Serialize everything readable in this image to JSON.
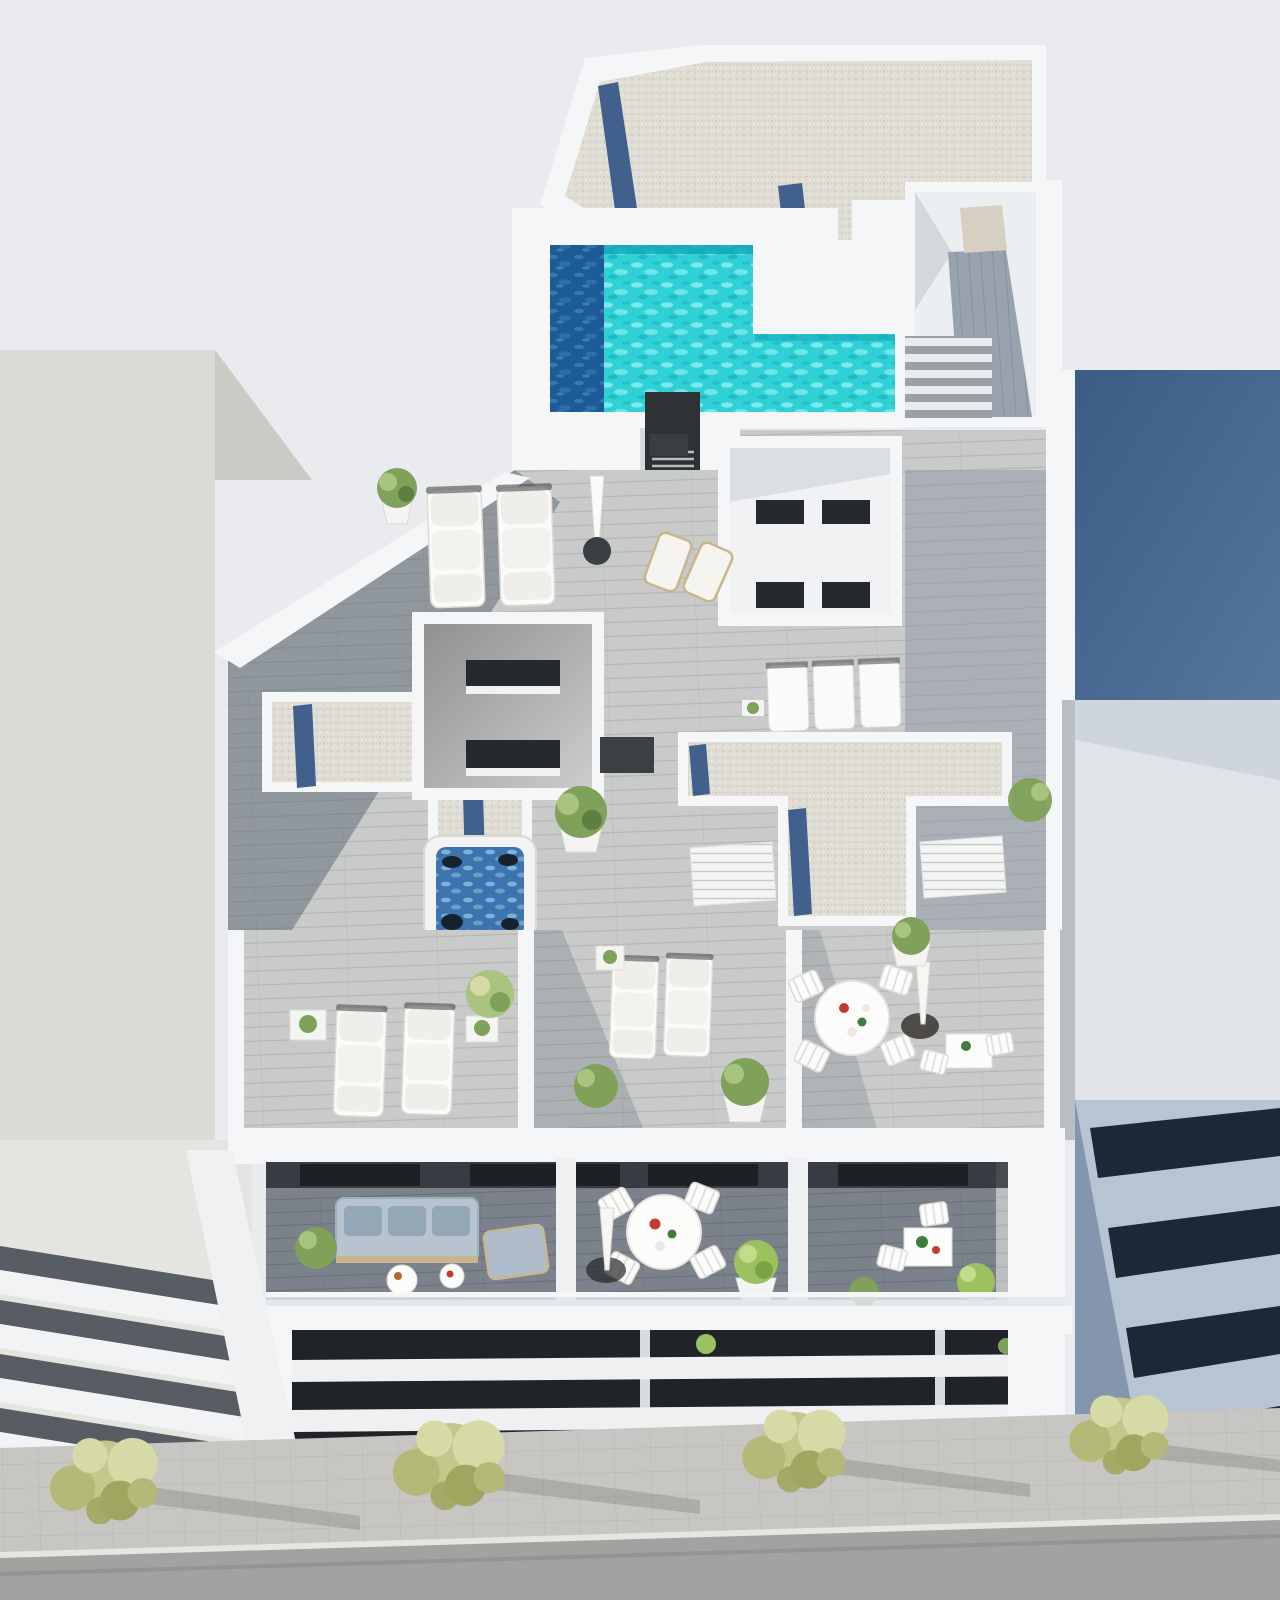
{
  "scene": {
    "description": "aerial-3d-render-of-white-apartment-building-rooftop-terraces",
    "rooftop": {
      "pool": {
        "shape": "L",
        "water": "turquoise",
        "deep_band": "navy-left-edge"
      },
      "gravel_roof_sections": 3,
      "solar_panel_strips": 6,
      "stair_headhouse": 1,
      "vent_chimney": 1
    },
    "terraces": {
      "sun_loungers": 9,
      "deck_chairs": 2,
      "parasols": 3,
      "jacuzzi": 1,
      "round_dining_tables": 2,
      "small_tables": 5,
      "chairs": 12,
      "sofa_sets": 1,
      "plant_pots": 14,
      "lightwell_courtyards": 2
    },
    "street": {
      "trees": 4,
      "sidewalk": "paved",
      "road": "asphalt"
    },
    "neighbors": {
      "left": "plain-light-grey-building",
      "right": "blue-grey-building-with-dark-window-bands"
    }
  },
  "colors": {
    "sky": "#e9ebee",
    "white1": "#f5f6f7",
    "white2": "#e8eaec",
    "whiteShade": "#d7dbdf",
    "nbLeft": "#dcdbd6",
    "nbLeftShade": "#cbcac4",
    "nbLeftWall": "#e4e4e0",
    "navyRoof1": "#3c5b85",
    "navyRoof2": "#56769e",
    "nbRightWall": "#e0e3e8",
    "bandNavy": "#1d2836",
    "bandLight": "#b7c4d3",
    "bandBlueGray": "#8496ad",
    "road": "#a3a2a0",
    "curb": "#e6e5e1",
    "pave": "#c7c6c2",
    "paveLine": "#b0afab",
    "deck": "#c9cbca",
    "deckLine": "#b4b6b5",
    "deckBlue": "#98a2ae",
    "deckBlueLine": "#87919e",
    "deckDark": "#7b828b",
    "deckDarkLine": "#6a707a",
    "gravel": "#e0ddd5",
    "gravelDot1": "#c8c4ba",
    "gravelDot2": "#f3f0e9",
    "panel": "#41608d",
    "panelDark": "#2c4468",
    "pool": "#2fd0d6",
    "poolLight": "#8ceef0",
    "poolDeep": "#1d5b97",
    "poolDeepLight": "#3b7fc0",
    "poolEdge": "#14a6b6",
    "jacuzzi": "#3d74ad",
    "jacuzziFoam": "#8fc0e2",
    "vent": "#2e3237",
    "window": "#26292d",
    "sill": "#f2f2f0",
    "doorBeige": "#d6cfc2",
    "tree1": "#c3c78c",
    "tree2": "#b4b977",
    "tree3": "#a0a65f",
    "treeHi": "#d6daa6",
    "plantGreen": "#7fa15a",
    "plantHi": "#a9c47e",
    "plantBright": "#9cc25f",
    "potWhite": "#f4f4f2",
    "sofa": "#b7c3ce",
    "sofaCushion": "#93a7b7",
    "woodFrame": "#c9b68e",
    "tableWhite": "#fcfcfb",
    "baseDark": "#3a3f44",
    "red": "#c43b2e",
    "green": "#3f7d3a",
    "shadow": "#46505f"
  }
}
